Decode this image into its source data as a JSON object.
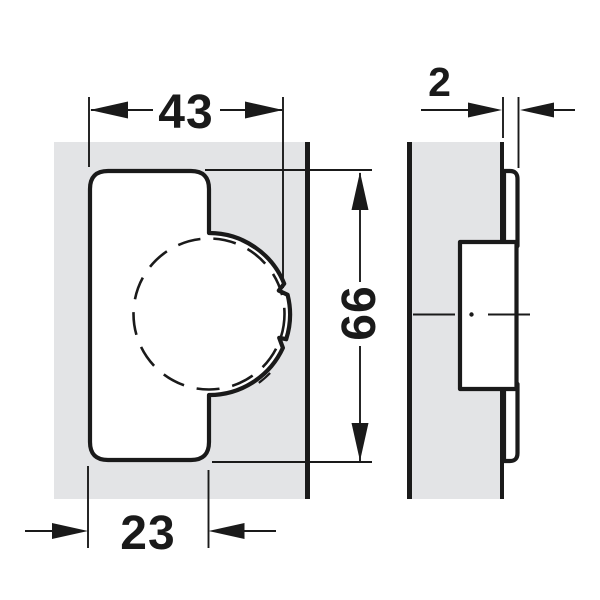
{
  "drawing": {
    "kind": "hinge-dimension-diagram",
    "dimensions": {
      "top_width": {
        "value": "43"
      },
      "height": {
        "value": "66"
      },
      "bottom_offset": {
        "value": "23"
      },
      "side_gap": {
        "value": "2"
      }
    }
  },
  "colors": {
    "background": "#ffffff",
    "panel": "#e3e4e6",
    "ink": "#1a1a1a"
  }
}
